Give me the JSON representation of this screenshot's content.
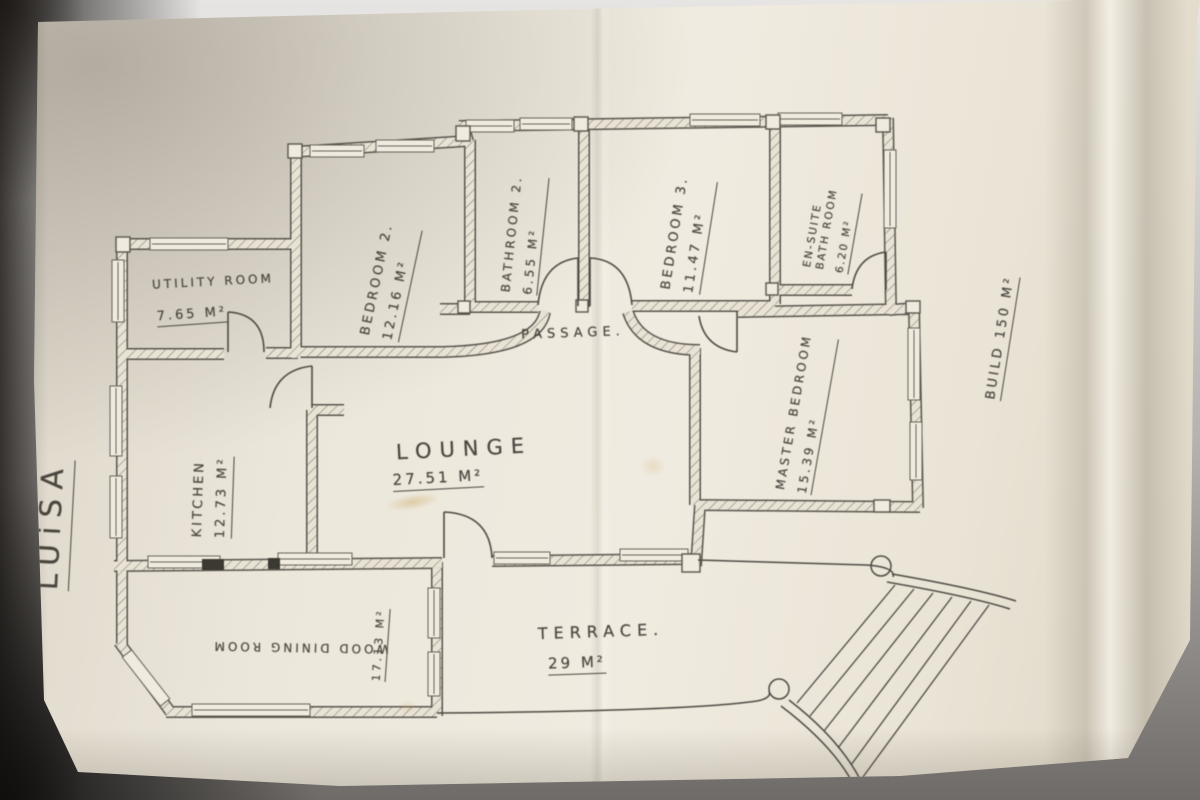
{
  "plan": {
    "title": "LUiSA",
    "total_area_note": "BUILD 150 M²",
    "rooms": [
      {
        "id": "utility",
        "name": "UTILITY ROOM",
        "area": "7.65 M²"
      },
      {
        "id": "bedroom2",
        "name": "BEDROOM 2.",
        "area": "12.16 M²"
      },
      {
        "id": "bathroom2",
        "name": "BATHROOM 2.",
        "area": "6.55 M²"
      },
      {
        "id": "bedroom3",
        "name": "BEDROOM 3.",
        "area": "11.47 M²"
      },
      {
        "id": "ensuite",
        "name": "EN-SUITE BATH ROOM",
        "name_line1": "EN-SUITE",
        "name_line2": "BATH ROOM",
        "area": "6.20 M²"
      },
      {
        "id": "passage",
        "name": "PASSAGE."
      },
      {
        "id": "kitchen",
        "name": "KITCHEN",
        "area": "12.73 M²"
      },
      {
        "id": "lounge",
        "name": "LOUNGE",
        "area": "27.51 M²"
      },
      {
        "id": "master",
        "name": "MASTER BEDROOM",
        "area": "15.39 M²"
      },
      {
        "id": "dining",
        "name": "WOOD DINING ROOM",
        "area": "17.13 M²"
      },
      {
        "id": "terrace",
        "name": "TERRACE.",
        "area": "29 M²"
      }
    ],
    "ink_color": "#4e4a44",
    "paper_color": "#ece7db"
  }
}
